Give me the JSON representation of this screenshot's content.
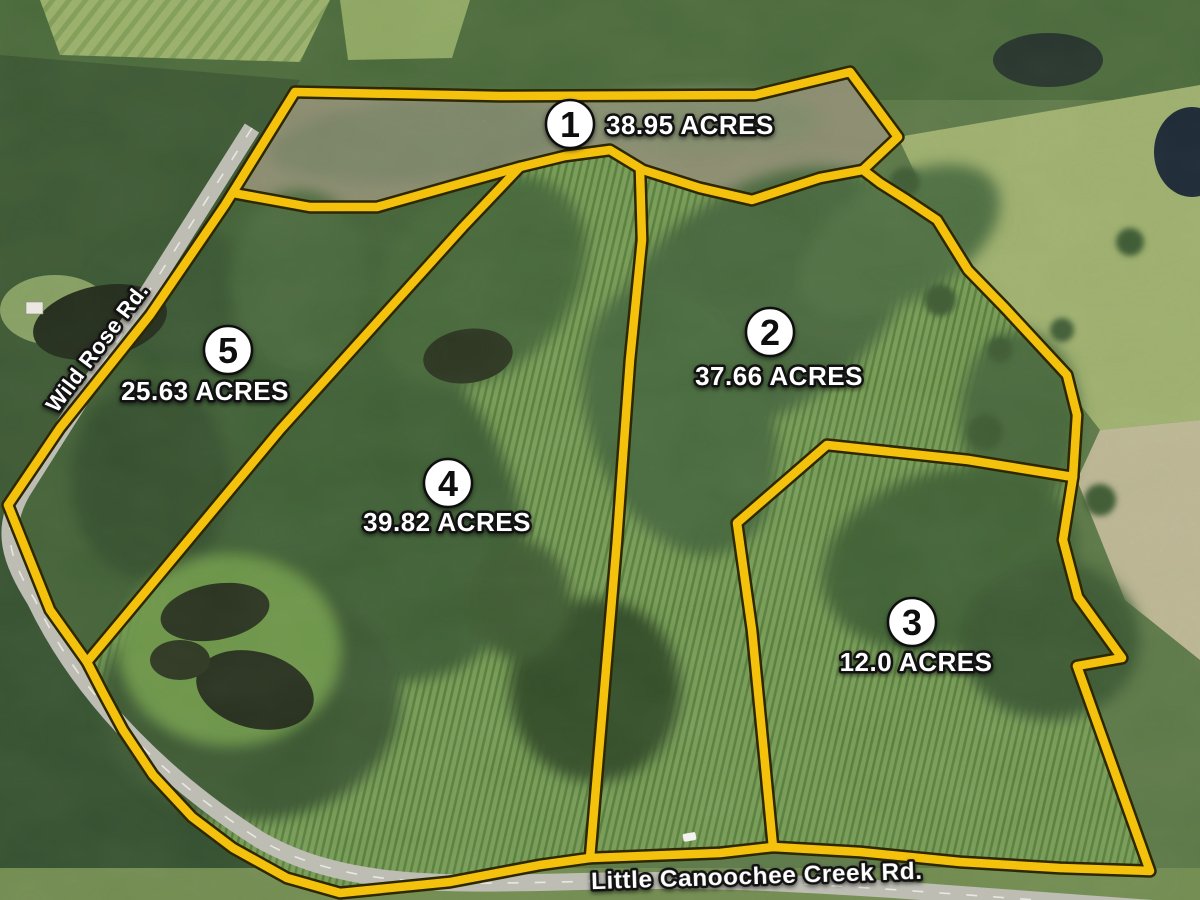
{
  "parcels": [
    {
      "number": "1",
      "acres": "38.95 ACRES"
    },
    {
      "number": "2",
      "acres": "37.66 ACRES"
    },
    {
      "number": "3",
      "acres": "12.0 ACRES"
    },
    {
      "number": "4",
      "acres": "39.82 ACRES"
    },
    {
      "number": "5",
      "acres": "25.63 ACRES"
    }
  ],
  "roads": {
    "west_road": "Wild Rose Rd.",
    "south_road": "Little Canoochee Creek Rd."
  },
  "colors": {
    "boundary_yellow": "#F4C20D",
    "label_text": "#FFFFFF",
    "label_outline": "#121212",
    "badge_fill": "#FFFFFF",
    "badge_stroke": "#0E0E0E",
    "badge_number": "#0E0E0E"
  }
}
